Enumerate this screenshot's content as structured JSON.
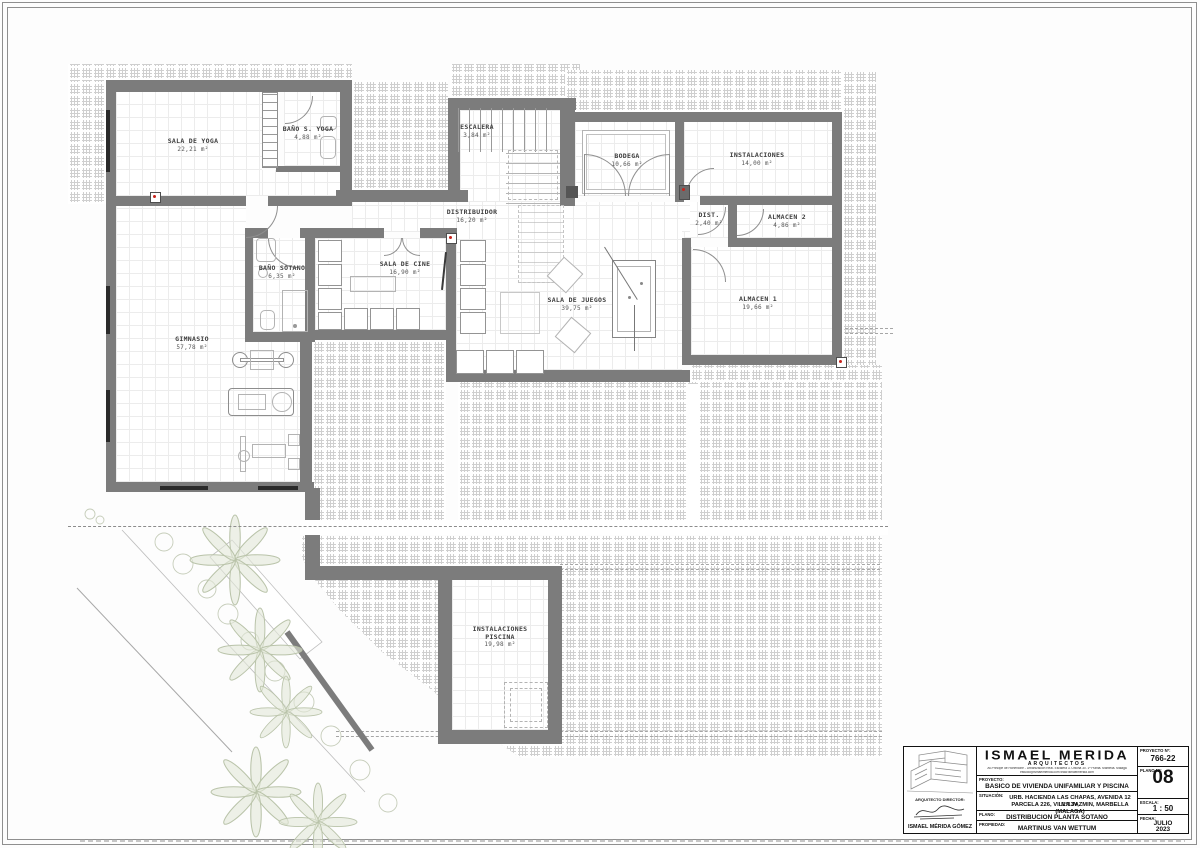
{
  "colors": {
    "wall": "#7c7c7c",
    "accent_red": "#c7231b",
    "landscape_green": "#ccd3bc",
    "hatch_line": "#cfcfcf"
  },
  "rooms": [
    {
      "name": "SALA DE YOGA",
      "area": "22,21 m²"
    },
    {
      "name": "BAÑO S. YOGA",
      "area": "4,88 m²"
    },
    {
      "name": "ESCALERA",
      "area": "3,84 m²"
    },
    {
      "name": "BODEGA",
      "area": "10,66 m²"
    },
    {
      "name": "DISTRIBUIDOR",
      "area": "16,20 m²"
    },
    {
      "name": "INSTALACIONES",
      "area": "14,00 m²"
    },
    {
      "name": "DIST.",
      "area": "2,40 m²"
    },
    {
      "name": "ALMACEN 2",
      "area": "4,86 m²"
    },
    {
      "name": "BAÑO SOTANO",
      "area": "6,35 m²"
    },
    {
      "name": "SALA DE CINE",
      "area": "16,90 m²"
    },
    {
      "name": "SALA DE JUEGOS",
      "area": "39,75 m²"
    },
    {
      "name": "ALMACEN 1",
      "area": "19,66 m²"
    },
    {
      "name": "GIMNASIO",
      "area": "57,78 m²"
    },
    {
      "name": "INSTALACIONES PISCINA",
      "area": "19,98 m²"
    }
  ],
  "title_block": {
    "firm": {
      "name": "ISMAEL MERIDA",
      "subtitle": "ARQUITECTOS",
      "address": "Av.Principe de Hohenlohe - Urbanización Real. Escalera 3. Oficina 30. 1ª Planta. Marbella. Málaga",
      "contact": "estudio@ismaelmerida.com        www.ismaelmerida.com"
    },
    "fields": {
      "proyecto_label": "PROYECTO:",
      "proyecto": "BASICO DE VIVIENDA UNIFAMILIAR Y PISCINA",
      "situacion_label": "SITUACIÓN:",
      "situacion_line1": "URB. HACIENDA LAS CHAPAS, AVENIDA 12 Nº13V,",
      "situacion_line2": "PARCELA 226, VILLA JAZMIN, MARBELLA (MALAGA)",
      "plano_label": "PLANO:",
      "plano": "DISTRIBUCION PLANTA SOTANO",
      "propiedad_label": "PROPIEDAD:",
      "propiedad": "MARTINUS VAN WETTUM",
      "proyecto_num_label": "PROYECTO Nº:",
      "proyecto_num": "766-22",
      "plano_num_label": "PLANO Nº:",
      "plano_num": "08",
      "escala_label": "ESCALA:",
      "escala": "1 : 50",
      "fecha_label": "FECHA:",
      "fecha_line1": "JULIO",
      "fecha_line2": "2023",
      "director_label": "ARQUITECTO DIRECTOR:",
      "director": "ISMAEL MÉRIDA GÓMEZ"
    }
  }
}
